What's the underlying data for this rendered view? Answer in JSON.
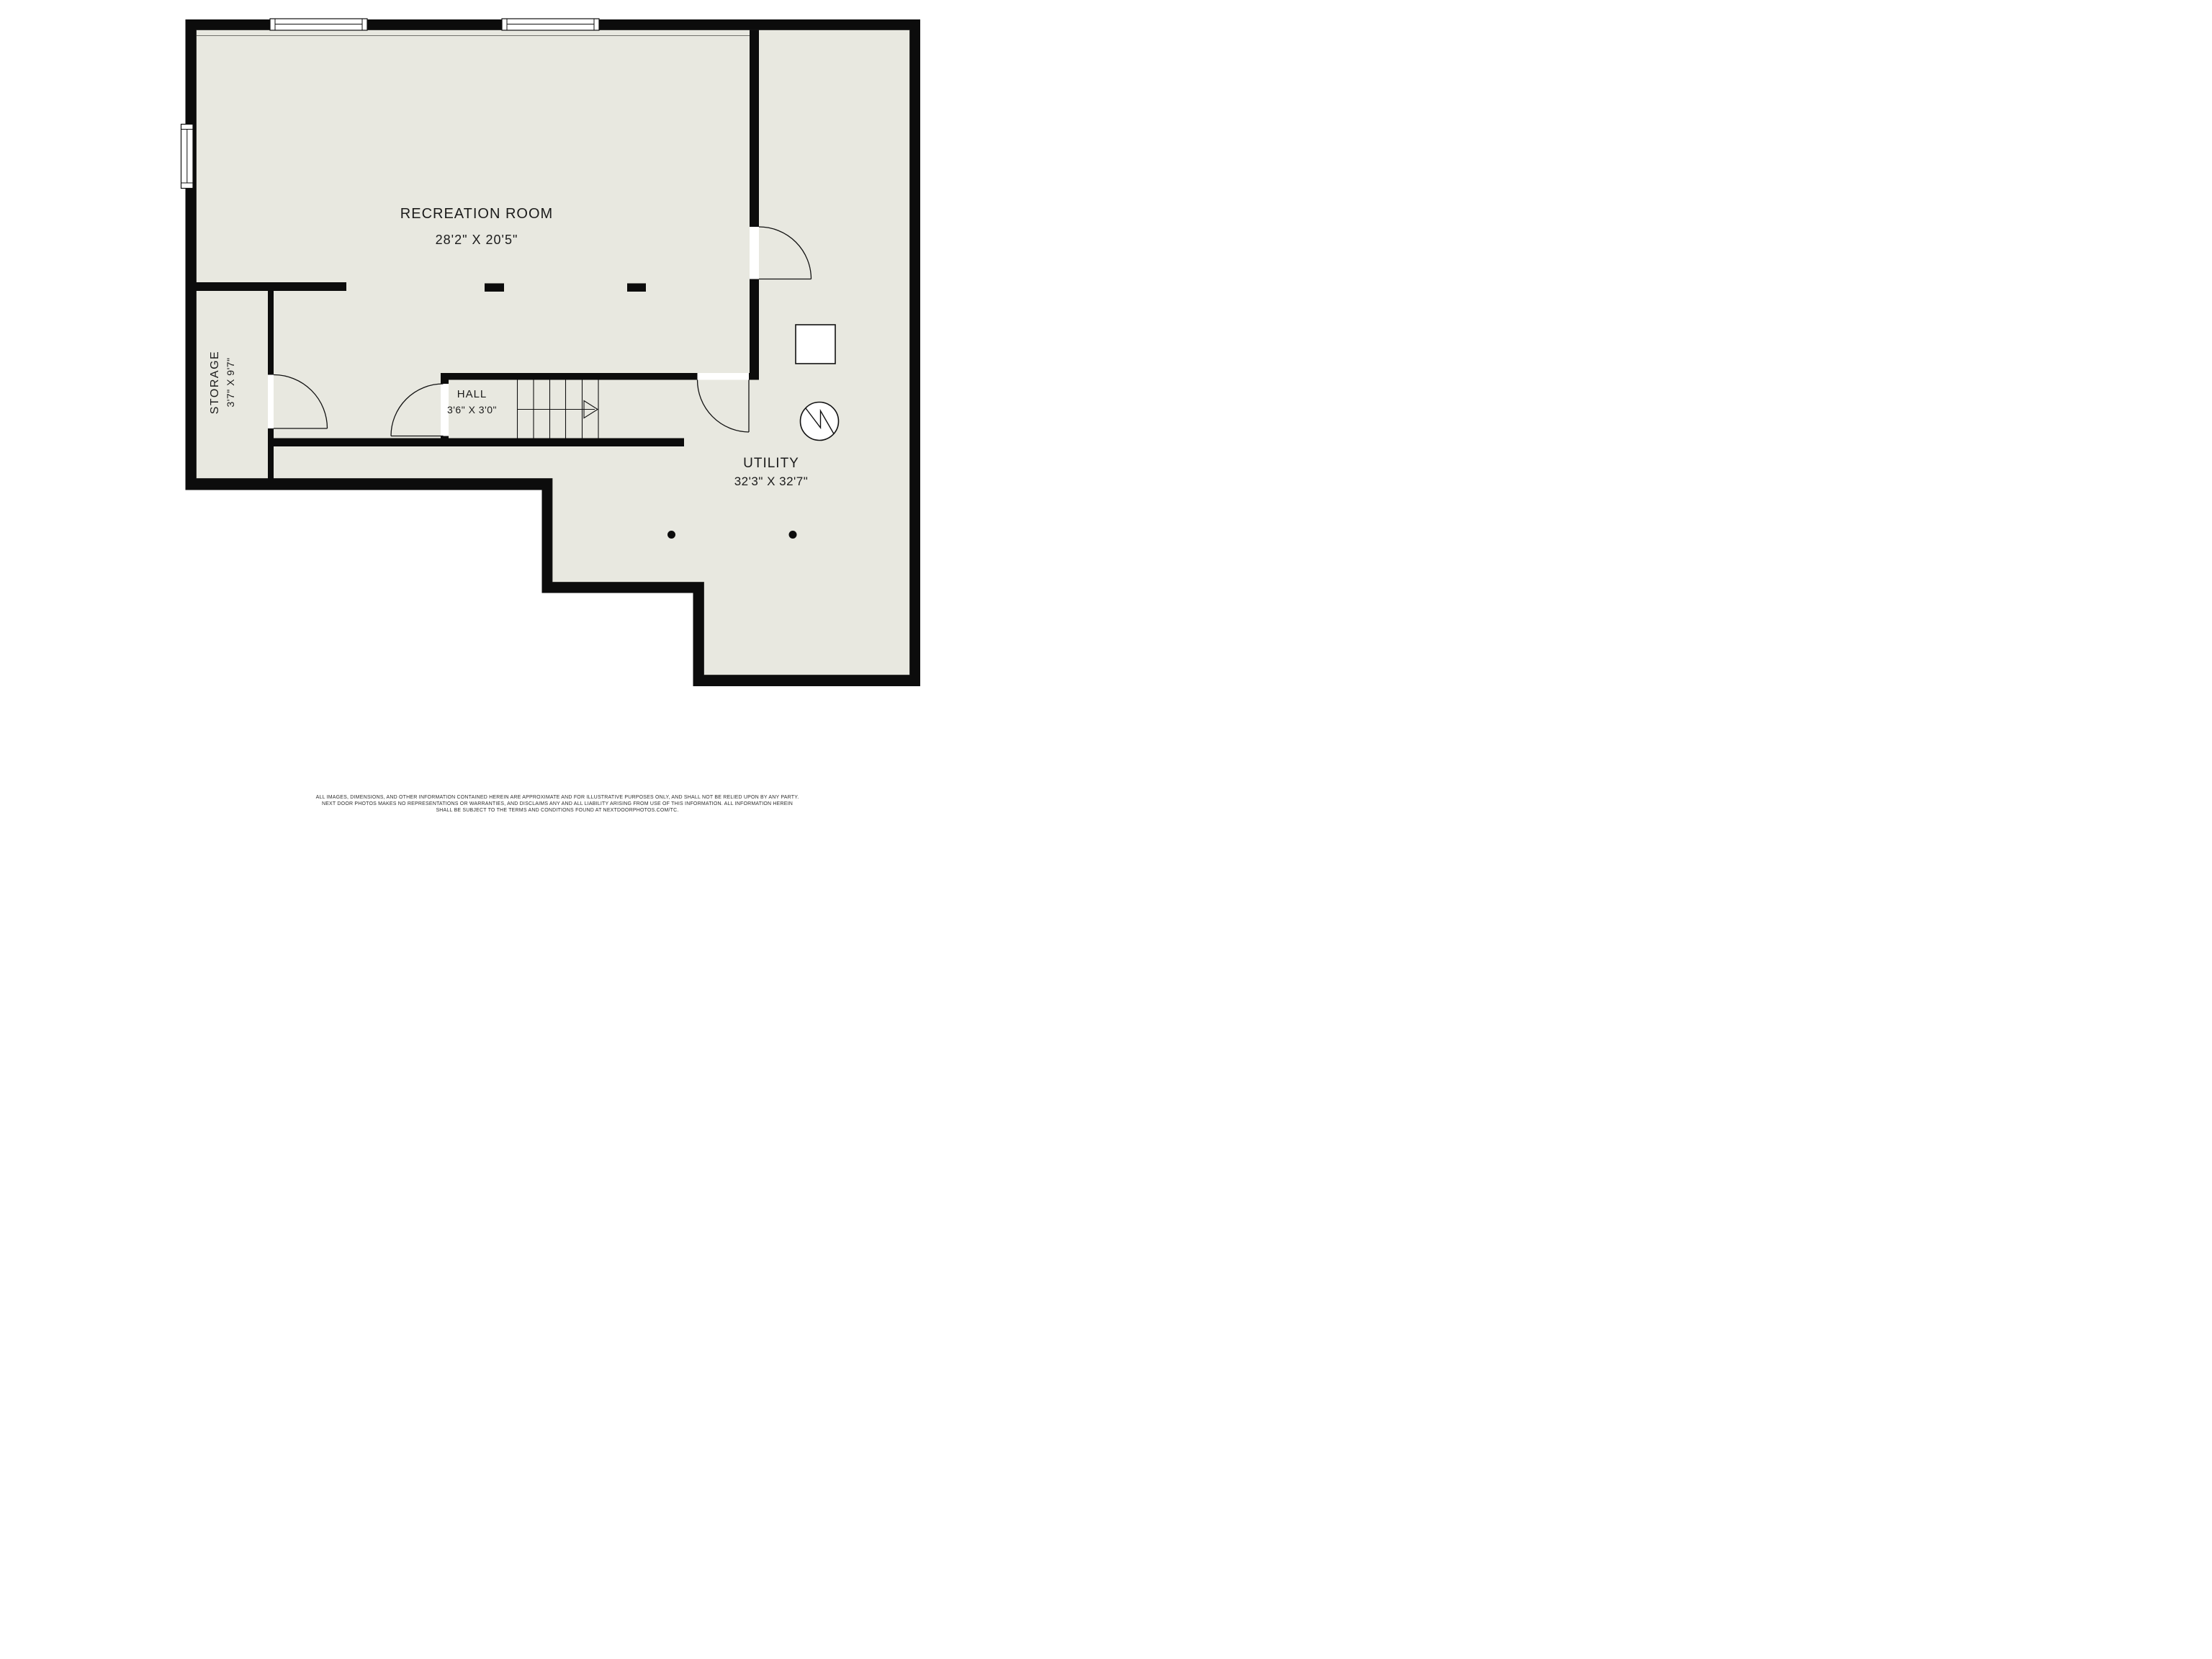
{
  "plan": {
    "floor_color": "#e8e8e0",
    "wall_color": "#0c0c0c",
    "rooms": [
      {
        "id": "recreation",
        "name": "RECREATION ROOM",
        "dims": "28'2\" X 20'5\""
      },
      {
        "id": "storage",
        "name": "STORAGE",
        "dims": "3'7\" X 9'7\""
      },
      {
        "id": "hall",
        "name": "HALL",
        "dims": "3'6\" X 3'0\""
      },
      {
        "id": "utility",
        "name": "UTILITY",
        "dims": "32'3\" X 32'7\""
      }
    ],
    "symbols": [
      "furnace-square-icon",
      "water-heater-circle-icon",
      "support-post-dot-icon",
      "stair-direction-arrow-icon",
      "door-swing-icon",
      "window-icon"
    ]
  },
  "footer": {
    "line1": "ALL IMAGES, DIMENSIONS, AND OTHER INFORMATION CONTAINED HEREIN ARE APPROXIMATE AND FOR ILLUSTRATIVE PURPOSES ONLY, AND SHALL NOT BE RELIED UPON BY ANY PARTY.",
    "line2": "NEXT DOOR PHOTOS MAKES NO REPRESENTATIONS OR WARRANTIES, AND DISCLAIMS ANY AND ALL LIABILITY ARISING FROM USE OF THIS INFORMATION. ALL INFORMATION HEREIN",
    "line3": "SHALL BE SUBJECT TO THE TERMS AND CONDITIONS FOUND AT NEXTDOORPHOTOS.COM/TC."
  }
}
